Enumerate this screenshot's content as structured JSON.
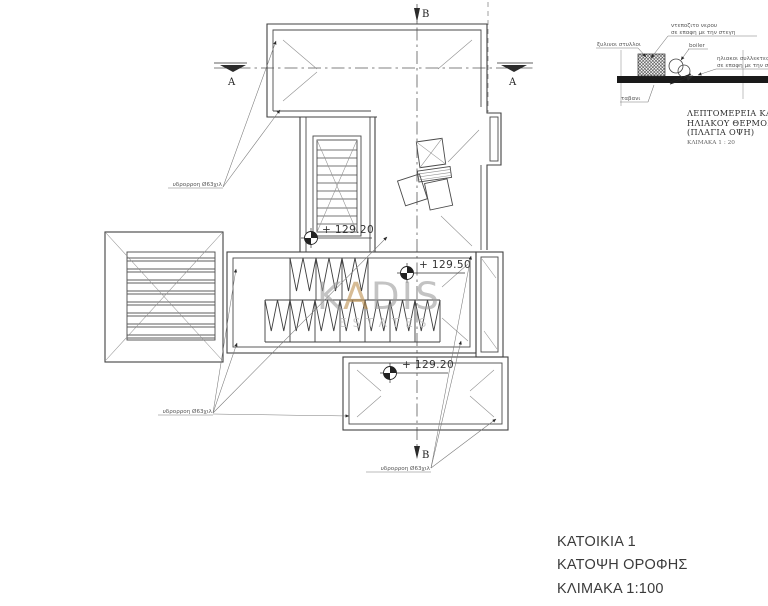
{
  "titleblock": {
    "line1": "ΚΑΤΟΙΚΙΑ 1",
    "line2": "ΚΑΤΟΨΗ ΟΡΟΦΗΣ",
    "line3": "ΚΛΙΜΑΚΑ 1:100"
  },
  "watermark": {
    "part1": "K",
    "accent": "A",
    "part2": "DIS",
    "sub": "ESTATES",
    "gray_color": "#9f9f9f",
    "sub_color": "#bdbdbd",
    "accent_color": "#bf9455"
  },
  "plan": {
    "section_label_a": "A",
    "section_label_b": "B",
    "levels": [
      {
        "value": "+ 129.20"
      },
      {
        "value": "+ 129.50"
      },
      {
        "value": "+ 129.20"
      }
    ],
    "downspout_labels": [
      {
        "text": "υδρορροη Ø63χιλ"
      },
      {
        "text": "υδρορροη Ø63χιλ"
      },
      {
        "text": "υδρορροη Ø63χιλ"
      }
    ]
  },
  "detail": {
    "label_tank_line1": "ντεποζιτο νερου",
    "label_tank_line2": "σε επαφη με την στεγη",
    "label_posts": "ξυλινοι στυλλοι",
    "label_boiler": "boiler",
    "label_collectors_line1": "ηλιακοι συλλεκτες",
    "label_collectors_line2": "σε επαφη με την στεγη",
    "label_slab": "ταβανι",
    "title_line1": "ΛΕΠΤΟΜΕΡΕΙΑ ΚΑΛΥΨ",
    "title_line2": "ΗΛΙΑΚΟΥ ΘΕΡΜΟΣΥΦΩ",
    "title_line3": "(ΠΛΑΓΙΑ ΟΨΗ)",
    "scale": "ΚΛΙΜΑΚΑ 1 : 20"
  }
}
